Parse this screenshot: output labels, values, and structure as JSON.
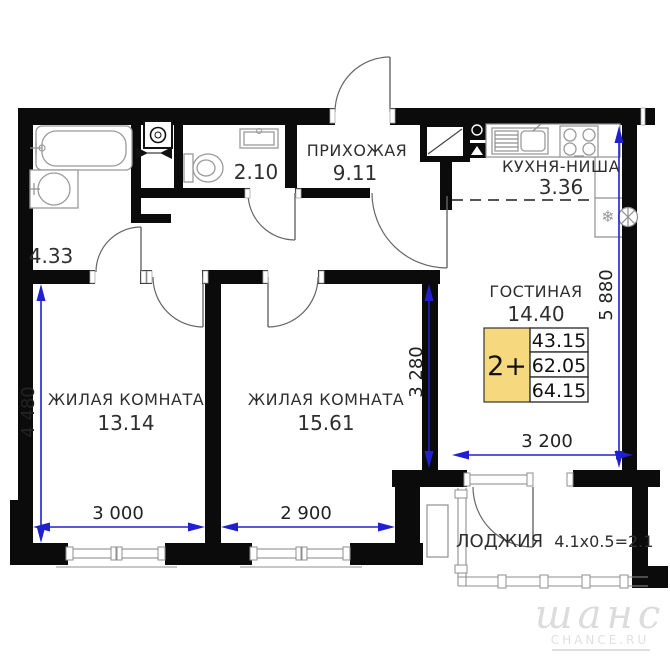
{
  "plan": {
    "rooms": {
      "hallway": {
        "name": "ПРИХОЖАЯ",
        "area": "9.11"
      },
      "kitchen": {
        "name": "КУХНЯ-НИША",
        "area": "3.36"
      },
      "living": {
        "name": "ГОСТИНАЯ",
        "area": "14.40"
      },
      "bedroom1": {
        "name": "ЖИЛАЯ КОМНАТА",
        "area": "13.14"
      },
      "bedroom2": {
        "name": "ЖИЛАЯ КОМНАТА",
        "area": "15.61"
      },
      "bathroom": {
        "area": "4.33"
      },
      "wc": {
        "area": "2.10"
      },
      "loggia": {
        "label": "ЛОДЖИЯ",
        "calc": "4.1x0.5=2.1"
      }
    },
    "info_box": {
      "type_label": "2+",
      "values": [
        "43.15",
        "62.05",
        "64.15"
      ],
      "accent_color": "#f6d97f"
    },
    "dimensions": {
      "left_vertical": "4 480",
      "bedroom1_width": "3 000",
      "bedroom2_width": "2 900",
      "living_height": "3 280",
      "living_width": "3 200",
      "right_vertical": "5 880",
      "line_color": "#2020d0"
    },
    "icons": {
      "fridge_snowflake": "❄"
    },
    "watermark": {
      "script": "шанс",
      "domain": "CHANCE.RU"
    }
  }
}
